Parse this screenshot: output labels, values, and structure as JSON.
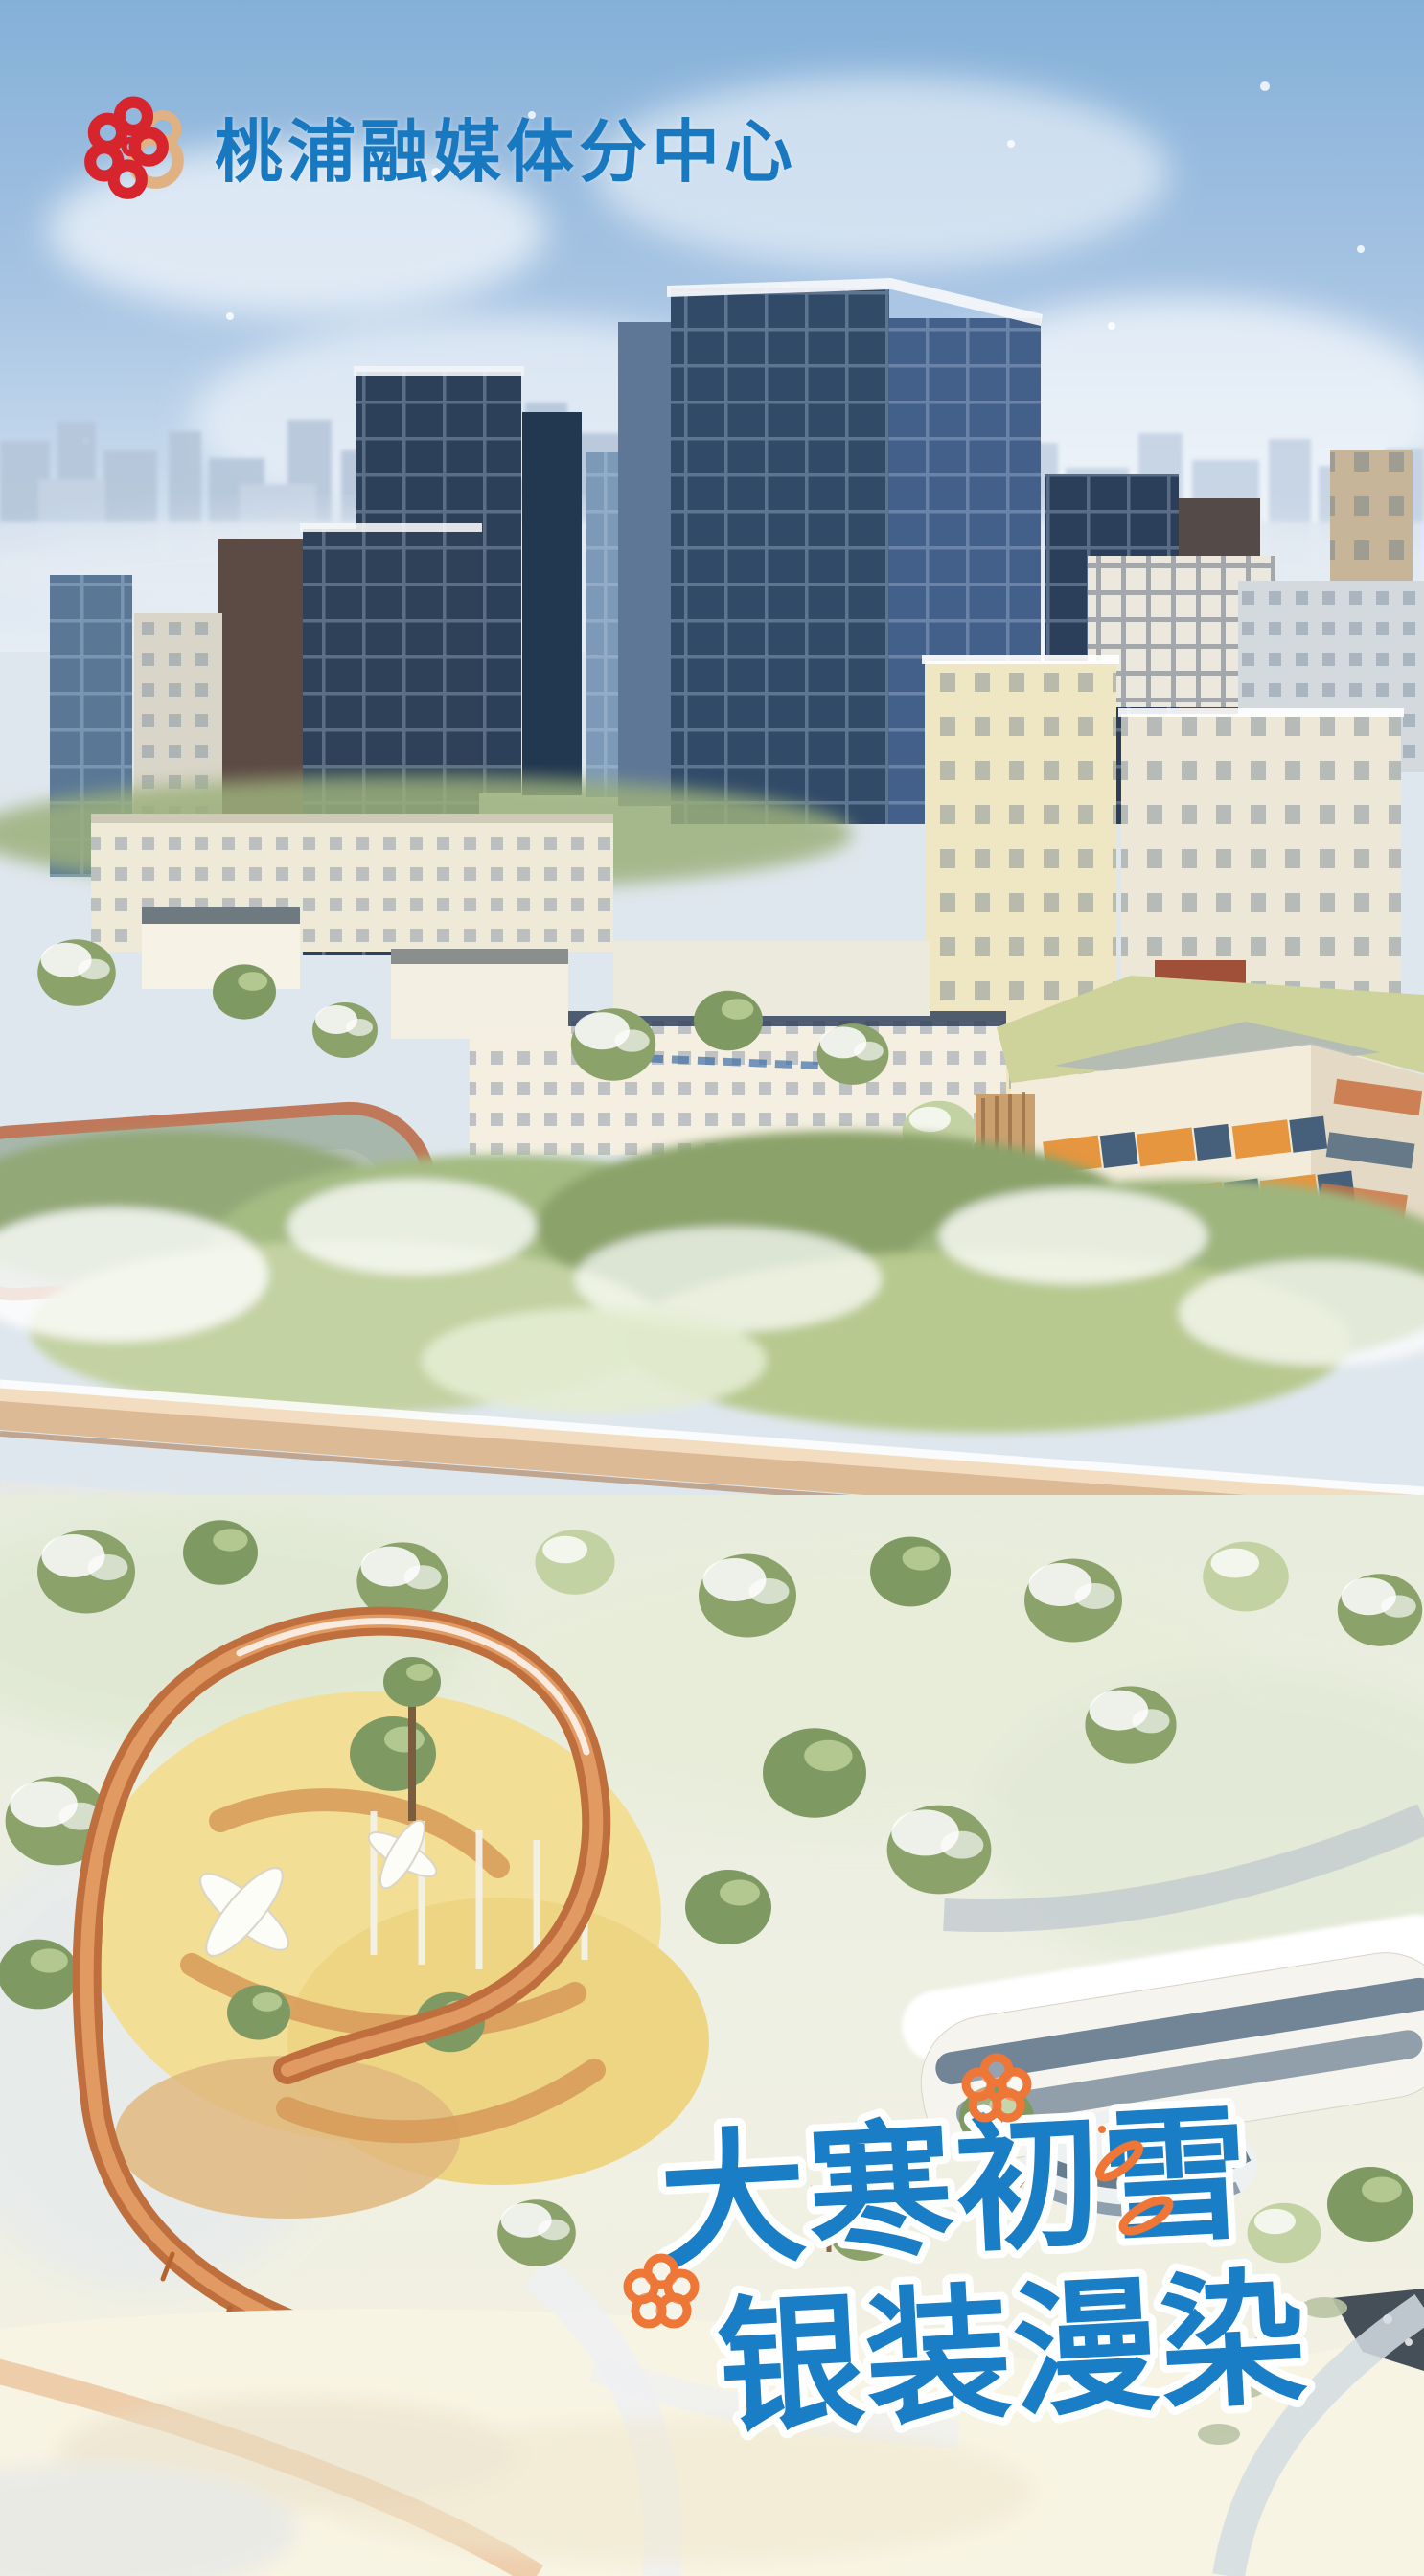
{
  "poster": {
    "brand": {
      "name": "桃浦融媒体分中心",
      "logo_icon": "peach-blossom-logo",
      "name_color": "#1878c0",
      "logo_colors": {
        "red": "#d6252d",
        "tan": "#dfb183"
      }
    },
    "title": {
      "line1": "大寒初雪",
      "line2": "银装漫染",
      "text_color": "#1a7ec6",
      "outline_color": "#ffffff"
    },
    "doodles": {
      "color": "#ee7636",
      "items": [
        {
          "name": "flower-doodle-top-right"
        },
        {
          "name": "flower-doodle-bottom-left"
        },
        {
          "name": "petal-doodle-right-upper"
        },
        {
          "name": "petal-doodle-right-lower"
        }
      ]
    },
    "scene_palette": {
      "sky_top": "#84b0d8",
      "sky_low": "#d6e3ef",
      "tower_dark": "#2f4763",
      "tower_side": "#42608a",
      "building_cream": "#f1ecdc",
      "tree_green": "#a4bb82",
      "snow": "#f8f4e6",
      "loop_orange": "#bf6e3e",
      "playground_yellow": "#f2dd90",
      "walkway_tan": "#dcba95",
      "school_window_orange": "#e5963f"
    }
  }
}
